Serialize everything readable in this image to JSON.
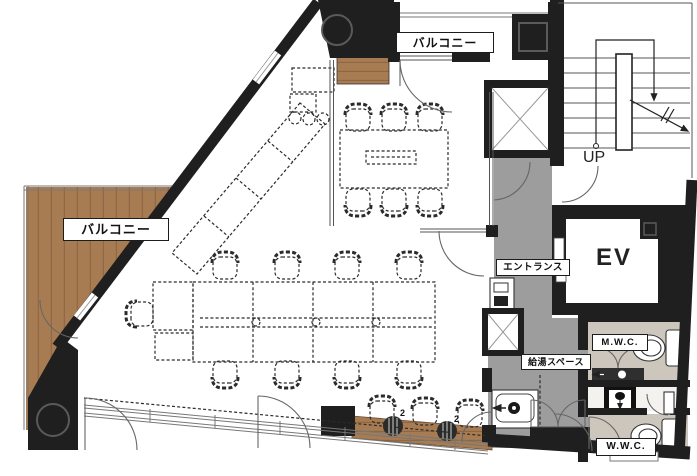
{
  "labels": {
    "balcony_top": "バルコニー",
    "balcony_left": "バルコニー",
    "up": "UP",
    "ev": "EV",
    "entrance": "エントランス",
    "kitchenette": "給湯スペース",
    "mens_wc": "M.W.C.",
    "womens_wc": "W.W.C.",
    "plant_count_1": "2",
    "plant_count_2": "2"
  },
  "colors": {
    "wall": "#1f1f1f",
    "wood": "#a87c52",
    "wood_dark": "#8a6342",
    "corridor": "#9d9d9d",
    "wc_floor": "#ccc6bc",
    "line": "#555555",
    "dash": "#2b2b2b"
  }
}
